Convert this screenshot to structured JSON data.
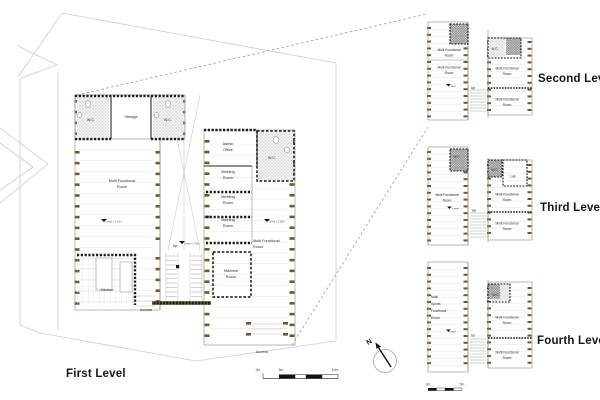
{
  "colors": {
    "wall": "#1c1c1c",
    "column_tick": "#6b5c1f",
    "site_line": "#cdcdcd",
    "hatch": "#b8b8b8",
    "text": "#2b2b2b"
  },
  "first_level": {
    "title": "First Level",
    "rooms": {
      "wc_left": "W.C.",
      "storage": "Storage",
      "wc_mid": "W.C.",
      "multi_functional": [
        "Multi Functional",
        "Room"
      ],
      "admin_office": [
        "Admin",
        "Office"
      ],
      "wc_right": "W.C.",
      "meeting_room_1": [
        "Meeting",
        "Room"
      ],
      "meeting_room_2": [
        "Meeting",
        "Room"
      ],
      "meeting_room_3": [
        "Meeting",
        "Room"
      ],
      "multi_functional_right": [
        "Multi Functional",
        "Room"
      ],
      "machine_room": [
        "Machine",
        "Room"
      ],
      "kitchen": "Kitchen"
    },
    "annotations": {
      "up": "Up",
      "level_marker": "Level +1.20m",
      "access_west": "Access",
      "access_south": "Access"
    }
  },
  "upper_levels": [
    {
      "title": "Second Level",
      "rooms": {
        "mfr_1": [
          "Multi Functional",
          "Room"
        ],
        "mfr_2": [
          "Multi Functional",
          "Room"
        ],
        "wc": "W.C.",
        "mfr_right": [
          "Multi Functional",
          "Room"
        ],
        "mfr_bottom": [
          "Multi Functional",
          "Room"
        ]
      },
      "annotations": {
        "up": "Up",
        "level_marker": "Level"
      }
    },
    {
      "title": "Third Level",
      "rooms": {
        "wc_top": "W.C.",
        "wc_mid": "W.C.",
        "lab": "Lab",
        "mfr_left": [
          "Multi Functional",
          "Room"
        ],
        "mfr_right": [
          "Multi Functional",
          "Room"
        ],
        "mfr_bottom": [
          "Multi Functional",
          "Room"
        ]
      },
      "annotations": {
        "up": "Up",
        "level_marker": "Level"
      }
    },
    {
      "title": "Fourth Level",
      "rooms": {
        "multi_sports": [
          "Multi",
          "Sports",
          "Functional",
          "Room"
        ],
        "wc": "W.C.",
        "mfr_right": [
          "Multi Functional",
          "Room"
        ],
        "mfr_bottom": [
          "Multi Functional",
          "Room"
        ]
      },
      "annotations": {
        "up": "Up",
        "level_marker": "Level"
      }
    }
  ],
  "north": {
    "label": "N"
  },
  "scale_bar_main": {
    "labels": [
      "0m",
      "5m",
      "10m"
    ]
  },
  "scale_bar_small": {
    "labels": [
      "0m",
      "5m"
    ]
  }
}
